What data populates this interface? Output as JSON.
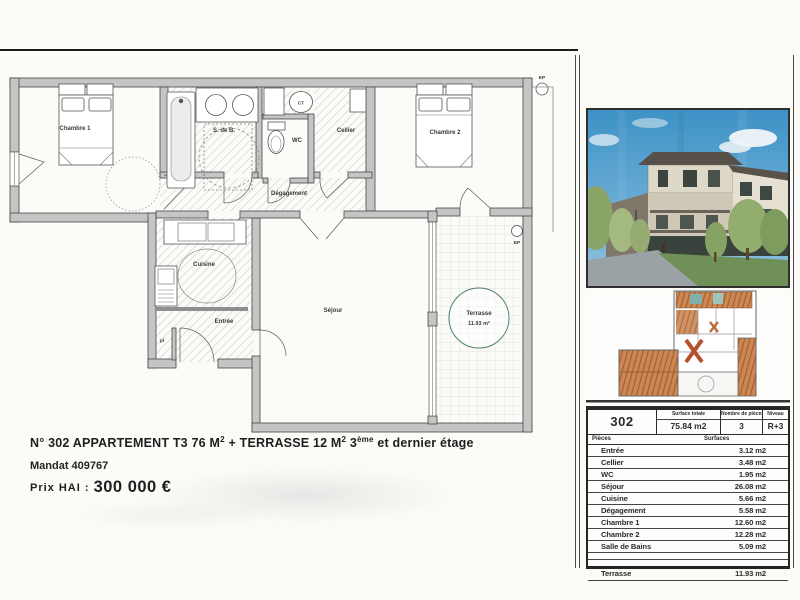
{
  "plan": {
    "rooms": {
      "chambre1": "Chambre 1",
      "sdb": "S. de B.",
      "wc": "WC",
      "ct": "CT",
      "cellier": "Cellier",
      "chambre2": "Chambre 2",
      "degagement": "Dégagement",
      "cuisine": "Cuisine",
      "entree": "Entrée",
      "pl": "pl",
      "sejour": "Séjour",
      "terrasse": "Terrasse",
      "terrasse_area": "11.93 m²",
      "ep": "EP"
    }
  },
  "info": {
    "line1_a": "N° 302  APPARTEMENT  T3  76 M",
    "line1_sup_a": "2",
    "line1_b": " + TERRASSE 12 M",
    "line1_sup_b": "2",
    "line1_c": "  3",
    "line1_sup_c": "ème",
    "line1_d": " et dernier étage",
    "mandat": "Mandat  409767",
    "price_label": "Prix HAI :",
    "price_value": "300 000 €"
  },
  "table": {
    "unit": "302",
    "surface_totale_label": "Surface totale",
    "surface_totale": "75.84 m2",
    "pieces_label": "Nombre de pièces",
    "pieces_count": "3",
    "niveau_label": "Niveau",
    "niveau": "R+3",
    "col_pieces": "Pièces",
    "col_surfaces": "Surfaces",
    "rows": [
      {
        "label": "Entrée",
        "value": "3.12 m2"
      },
      {
        "label": "Cellier",
        "value": "3.48 m2"
      },
      {
        "label": "WC",
        "value": "1.95 m2"
      },
      {
        "label": "Séjour",
        "value": "26.08 m2"
      },
      {
        "label": "Cuisine",
        "value": "5.66 m2"
      },
      {
        "label": "Dégagement",
        "value": "5.58 m2"
      },
      {
        "label": "Chambre 1",
        "value": "12.60 m2"
      },
      {
        "label": "Chambre 2",
        "value": "12.28 m2"
      },
      {
        "label": "Salle de Bains",
        "value": "5.09 m2"
      }
    ],
    "terrasse_row": {
      "label": "Terrasse",
      "value": "11.93 m2"
    }
  },
  "colors": {
    "wall_gray": "#c5c5c5",
    "deck_orange": "#cd8752",
    "sky_blue": "#3e92c6",
    "ink": "#262626"
  }
}
